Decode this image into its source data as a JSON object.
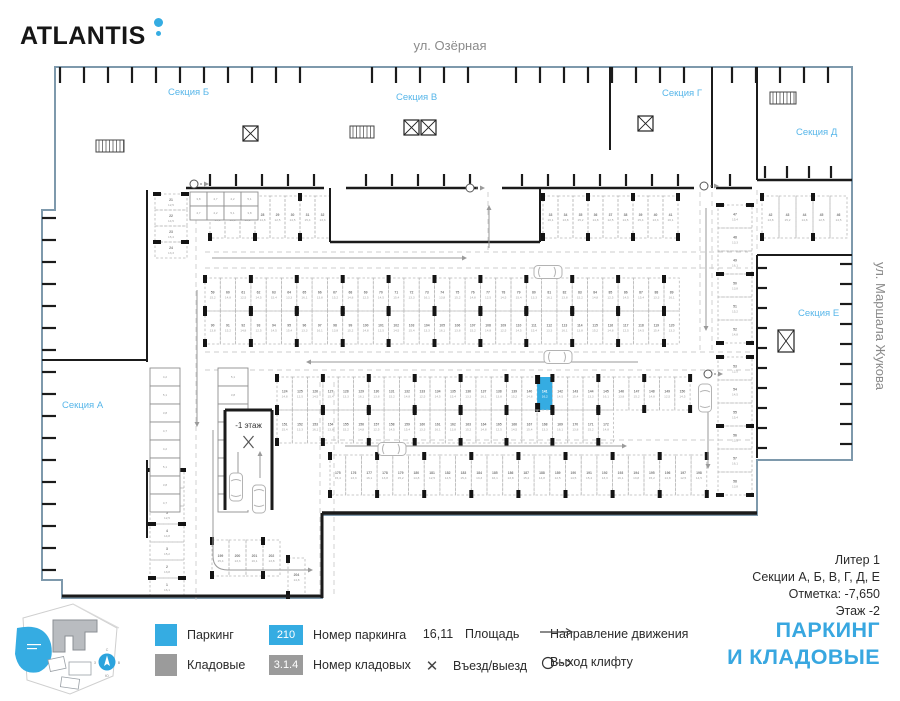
{
  "header": {
    "brand": "ATLANTIS",
    "street_top": "ул. Озёрная",
    "street_right": "ул. Маршала Жукова"
  },
  "colors": {
    "accent": "#35ace2",
    "compass_blue": "#2ba3dd",
    "storage_gray": "#9b9b9b",
    "wall": "#1b1b1b",
    "boundary": "#7e99ac",
    "section_label": "#57b6e9",
    "title_blue": "#38a7e0"
  },
  "info": {
    "line1": "Литер 1",
    "line2": "Секции А, Б, В, Г, Д, Е",
    "line3": "Отметка:  -7,650",
    "line4": "Этаж  -2"
  },
  "title": {
    "line1": "ПАРКИНГ",
    "line2": "И КЛАДОВЫЕ"
  },
  "legend": {
    "parking_label": "Паркинг",
    "storage_label": "Кладовые",
    "parking_number_example": "210",
    "parking_number_label": "Номер паркинга",
    "storage_number_example": "3.1.4",
    "storage_number_label": "Номер кладовых",
    "area_example": "16,11",
    "area_label": "Площадь",
    "entry_icon": "✕",
    "entry_label": "Въезд/выезд",
    "direction_label": "Направление движения",
    "lift_label": "Выход клифту"
  },
  "minimap": {
    "compass": {
      "n": "С",
      "e": "В",
      "s": "Ю",
      "w": "З"
    }
  },
  "plan": {
    "outline": [
      [
        55,
        67
      ],
      [
        852,
        67
      ],
      [
        852,
        460
      ],
      [
        757,
        460
      ],
      [
        757,
        515
      ],
      [
        322,
        515
      ],
      [
        322,
        598
      ],
      [
        62,
        598
      ],
      [
        62,
        580
      ],
      [
        42,
        580
      ],
      [
        42,
        210
      ],
      [
        55,
        210
      ]
    ],
    "sections": [
      {
        "label": "Секция А",
        "x": 62,
        "y": 408
      },
      {
        "label": "Секция Б",
        "x": 168,
        "y": 95
      },
      {
        "label": "Секция В",
        "x": 396,
        "y": 100
      },
      {
        "label": "Секция Г",
        "x": 662,
        "y": 96
      },
      {
        "label": "Секция Д",
        "x": 796,
        "y": 135
      },
      {
        "label": "Секция Е",
        "x": 798,
        "y": 316
      }
    ],
    "ramp": {
      "x": 225,
      "y": 410,
      "w": 47,
      "h": 100,
      "label": "-1 этаж"
    },
    "highlight": {
      "row": "mid2-up",
      "index": 17,
      "number": "141",
      "area": "16,2"
    },
    "area_pool": [
      "13,3",
      "15,2",
      "14,5",
      "16,1",
      "14,8",
      "15,4",
      "13,8",
      "12,5"
    ],
    "storage_area_pool": [
      "4,2",
      "5,1",
      "3,8",
      "4,7"
    ],
    "rows": [
      {
        "id": "lcol-top",
        "type": "col",
        "x": 155,
        "y": 194,
        "count": 4,
        "w": 32,
        "h": 16,
        "start": 21
      },
      {
        "id": "row-a",
        "type": "row",
        "x": 210,
        "y": 196,
        "count": 8,
        "w": 15,
        "h": 42,
        "start": 25
      },
      {
        "id": "row-b",
        "type": "row",
        "x": 543,
        "y": 196,
        "count": 9,
        "w": 15,
        "h": 42,
        "start": 33
      },
      {
        "id": "row-rt",
        "type": "row",
        "x": 762,
        "y": 196,
        "count": 5,
        "w": 17,
        "h": 42,
        "start": 42
      },
      {
        "id": "rcol-1",
        "type": "col",
        "x": 718,
        "y": 205,
        "count": 6,
        "w": 34,
        "h": 23,
        "start": 47
      },
      {
        "id": "rcol-2",
        "type": "col",
        "x": 718,
        "y": 357,
        "count": 6,
        "w": 34,
        "h": 23,
        "start": 53
      },
      {
        "id": "mid1-up",
        "type": "row",
        "x": 205,
        "y": 278,
        "count": 31,
        "w": 15.3,
        "h": 33,
        "start": 59
      },
      {
        "id": "mid1-lo",
        "type": "row",
        "x": 205,
        "y": 311,
        "count": 31,
        "w": 15.3,
        "h": 33,
        "start": 90
      },
      {
        "id": "mid2-up",
        "type": "row",
        "x": 277,
        "y": 377,
        "count": 27,
        "w": 15.3,
        "h": 33,
        "start": 124
      },
      {
        "id": "mid2-lo",
        "type": "row",
        "x": 277,
        "y": 410,
        "count": 22,
        "w": 15.3,
        "h": 33,
        "start": 151
      },
      {
        "id": "bottom",
        "type": "row",
        "x": 330,
        "y": 455,
        "count": 24,
        "w": 15.7,
        "h": 40,
        "start": 175
      },
      {
        "id": "bl-col",
        "type": "col",
        "x": 150,
        "y": 470,
        "count": 7,
        "w": 34,
        "h": 18,
        "start": 7,
        "step": -1
      },
      {
        "id": "bl-row",
        "type": "row",
        "x": 212,
        "y": 540,
        "count": 4,
        "w": 17,
        "h": 36,
        "start": 199
      },
      {
        "id": "bl-single",
        "type": "row",
        "x": 288,
        "y": 558,
        "count": 1,
        "w": 17,
        "h": 38,
        "start": 204
      }
    ],
    "storages": [
      {
        "x": 150,
        "y": 368,
        "rows": 8,
        "cols": 1,
        "w": 30,
        "h": 18
      },
      {
        "x": 218,
        "y": 368,
        "rows": 8,
        "cols": 1,
        "w": 30,
        "h": 18
      },
      {
        "x": 190,
        "y": 192,
        "rows": 2,
        "cols": 4,
        "w": 17,
        "h": 14
      }
    ],
    "walls": [
      [
        186,
        188,
        324,
        188,
        2.5
      ],
      [
        346,
        188,
        478,
        188,
        2.5
      ],
      [
        502,
        188,
        694,
        188,
        2.5
      ],
      [
        716,
        188,
        752,
        188,
        2.5
      ],
      [
        330,
        188,
        330,
        242,
        2
      ],
      [
        540,
        188,
        540,
        242,
        2
      ],
      [
        330,
        242,
        540,
        242,
        2.5
      ],
      [
        42,
        360,
        148,
        360,
        2
      ],
      [
        147,
        190,
        147,
        362,
        2
      ],
      [
        147,
        460,
        147,
        538,
        2
      ],
      [
        757,
        67,
        757,
        180,
        2
      ],
      [
        757,
        180,
        852,
        180,
        2.5
      ],
      [
        757,
        255,
        852,
        255,
        2
      ],
      [
        757,
        255,
        757,
        458,
        2
      ],
      [
        610,
        67,
        610,
        150,
        2
      ],
      [
        712,
        67,
        712,
        188,
        2
      ],
      [
        322,
        513,
        757,
        513,
        3.5
      ],
      [
        322,
        513,
        322,
        598,
        3
      ],
      [
        62,
        596,
        322,
        596,
        3
      ],
      [
        225,
        410,
        272,
        410,
        3
      ],
      [
        225,
        410,
        225,
        510,
        3
      ],
      [
        272,
        410,
        272,
        510,
        3
      ]
    ],
    "combs": [
      {
        "dir": "down",
        "fixed": 67,
        "from": 60,
        "to": 846,
        "len": 16,
        "step": 24,
        "skips": [
          [
            318,
            352
          ],
          [
            474,
            506
          ],
          [
            690,
            720
          ]
        ]
      },
      {
        "dir": "up",
        "fixed": 186,
        "from": 210,
        "to": 740,
        "len": 12,
        "step": 26,
        "skips": [
          [
            318,
            352
          ],
          [
            474,
            506
          ],
          [
            690,
            720
          ]
        ]
      },
      {
        "dir": "right",
        "fixed": 42,
        "from": 218,
        "to": 572,
        "len": 14,
        "step": 22,
        "skips": []
      },
      {
        "dir": "left",
        "fixed": 852,
        "from": 264,
        "to": 448,
        "len": 12,
        "step": 20,
        "skips": []
      },
      {
        "dir": "up",
        "fixed": 178,
        "from": 765,
        "to": 845,
        "len": 12,
        "step": 22,
        "skips": []
      },
      {
        "dir": "right",
        "fixed": 757,
        "from": 268,
        "to": 450,
        "len": 10,
        "step": 20,
        "skips": []
      }
    ],
    "lanes": [
      [
        205,
        252,
        748,
        252
      ],
      [
        205,
        268,
        748,
        268
      ],
      [
        205,
        352,
        752,
        352
      ],
      [
        205,
        370,
        752,
        370
      ],
      [
        322,
        440,
        750,
        440
      ],
      [
        488,
        192,
        488,
        250
      ],
      [
        700,
        192,
        700,
        350
      ],
      [
        712,
        192,
        712,
        350
      ],
      [
        320,
        382,
        320,
        596
      ],
      [
        334,
        382,
        334,
        596
      ],
      [
        196,
        192,
        196,
        600
      ],
      [
        757,
        190,
        757,
        252
      ]
    ],
    "arrows": [
      "M212,258 H466",
      "M638,362 H307",
      "M345,446 H626",
      "M197,290 V426",
      "M706,208 V330",
      "M213,430 V556 Q213,570 228,570 H312",
      "M489,248 V206",
      "M238,452 V478",
      "M260,478 V452",
      "M708,390 V468"
    ],
    "exits": [
      [
        194,
        184
      ],
      [
        470,
        188
      ],
      [
        704,
        186
      ],
      [
        708,
        374
      ]
    ],
    "elevators": [
      [
        243,
        126,
        15,
        15
      ],
      [
        404,
        120,
        15,
        15
      ],
      [
        421,
        120,
        15,
        15
      ],
      [
        638,
        116,
        15,
        15
      ],
      [
        778,
        330,
        16,
        22
      ]
    ],
    "stairs": [
      [
        96,
        140,
        28,
        12
      ],
      [
        350,
        126,
        24,
        12
      ],
      [
        770,
        92,
        26,
        12
      ]
    ],
    "cars": [
      {
        "x": 548,
        "y": 272,
        "r": 90
      },
      {
        "x": 558,
        "y": 357,
        "r": 90
      },
      {
        "x": 392,
        "y": 449,
        "r": 90
      },
      {
        "x": 236,
        "y": 487,
        "r": 0
      },
      {
        "x": 259,
        "y": 499,
        "r": 180
      },
      {
        "x": 705,
        "y": 398,
        "r": 0
      }
    ]
  }
}
